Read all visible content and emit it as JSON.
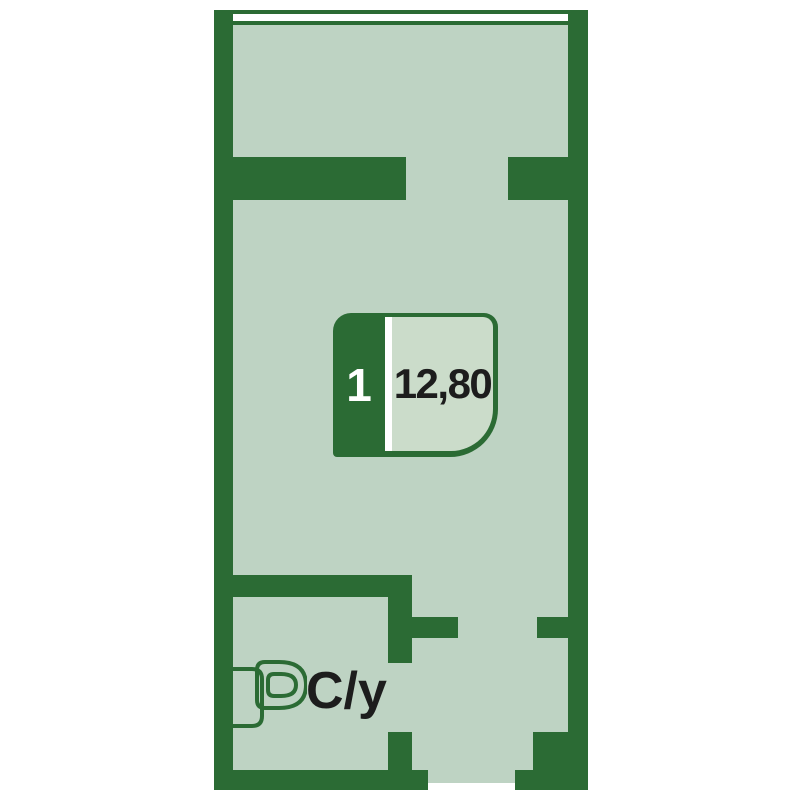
{
  "plan": {
    "badge": {
      "room_number": "1",
      "area": "12,80"
    },
    "bathroom": {
      "icon": "toilet-icon",
      "label": "С/у"
    }
  },
  "colors": {
    "wall": "#2b6b34",
    "floor": "#bed3c3",
    "badge-fill": "#cbdcca",
    "window": "#ffffff",
    "ink": "#1d1d1d",
    "room-number-color": "#ffffff"
  }
}
